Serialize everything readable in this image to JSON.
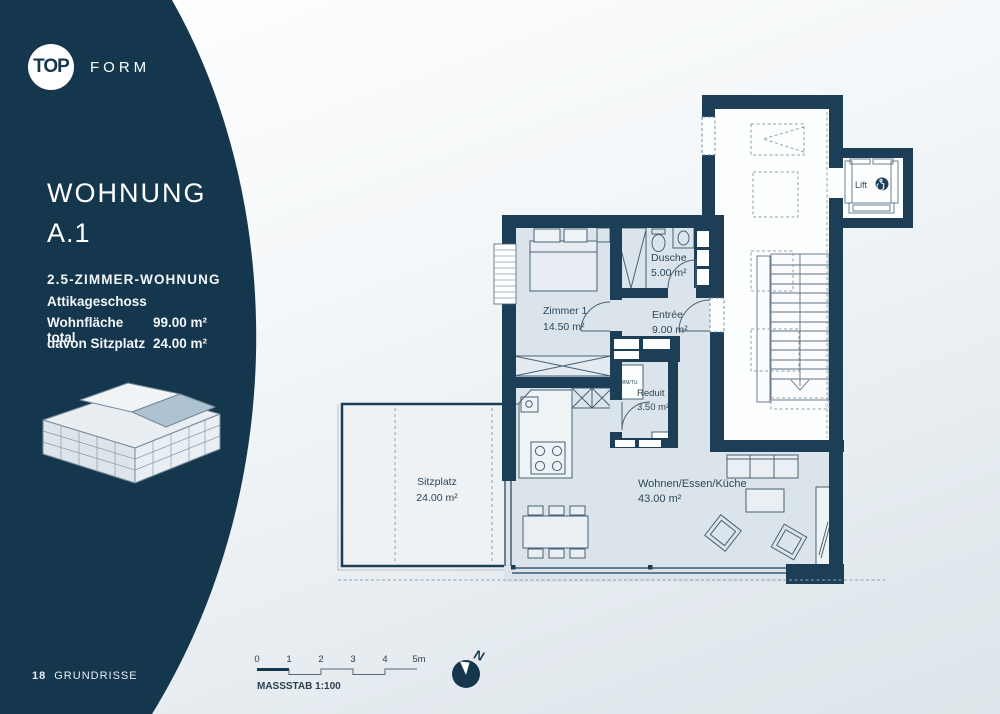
{
  "brand": {
    "top": "TOP",
    "form": "FORM"
  },
  "sidebar": {
    "title1": "WOHNUNG",
    "title2": "A.1",
    "type": "2.5-ZIMMER-WOHNUNG",
    "floor": "Attikageschoss",
    "rows": [
      {
        "label": "Wohnfläche total",
        "value": "99.00 m²"
      },
      {
        "label": "davon Sitzplatz",
        "value": "24.00 m²"
      }
    ],
    "page_number": "18",
    "page_section": "GRUNDRISSE"
  },
  "plan": {
    "rooms": [
      {
        "name": "Zimmer 1",
        "area": "14.50 m²"
      },
      {
        "name": "Dusche",
        "area": "5.00 m²"
      },
      {
        "name": "Entrée",
        "area": "9.00 m²"
      },
      {
        "name": "Reduit",
        "area": "3.50 m²"
      },
      {
        "name": "Wohnen/Essen/Küche",
        "area": "43.00 m²"
      },
      {
        "name": "Sitzplatz",
        "area": "24.00 m²"
      }
    ],
    "lift": "Lift",
    "appliance": "WM/TU"
  },
  "footer": {
    "ticks": [
      "0",
      "1",
      "2",
      "3",
      "4",
      "5m"
    ],
    "scale": "MASSSTAB 1:100",
    "north": "N"
  },
  "colors": {
    "navy_sidebar": "#15374d",
    "navy_wall": "#1c3e57",
    "room_fill": "#dbe4ea",
    "terrace_fill": "#eef2f5",
    "highlight_unit": "#aec3d2"
  }
}
